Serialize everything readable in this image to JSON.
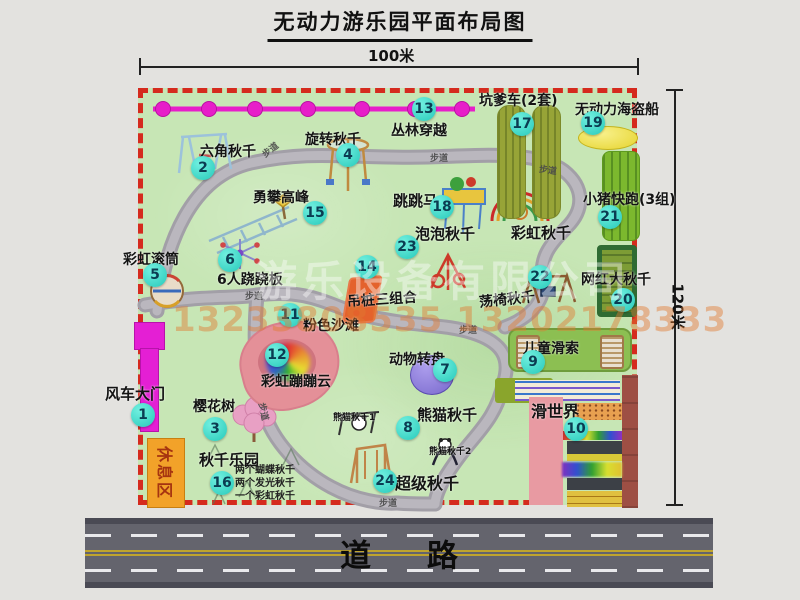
{
  "title": "无动力游乐园平面布局图",
  "dimensions": {
    "top": "100米",
    "right": "120米"
  },
  "road_label": "道路",
  "watermark": {
    "company": "游乐设备有限公司",
    "phone": "13233808535 13202178333"
  },
  "labels": {
    "walkway": "步道",
    "rainbow_swing": "彩虹秋千",
    "rest_area": "休息区"
  },
  "colors": {
    "map_green": "#c7e6b5",
    "border_red": "#d52a1e",
    "zipline_pink": "#e71ec9",
    "marker_cyan": "#27c9ba",
    "rest_orange": "#f2a229",
    "road_gray": "#64646d",
    "gate_magenta": "#e41fd4"
  },
  "attractions": [
    {
      "num": "1",
      "label": "风车大门"
    },
    {
      "num": "2",
      "label": "六角秋千"
    },
    {
      "num": "3",
      "label": "樱花树"
    },
    {
      "num": "4",
      "label": "旋转秋千"
    },
    {
      "num": "5",
      "label": "彩虹滚筒"
    },
    {
      "num": "6",
      "label": "6人跷跷板"
    },
    {
      "num": "7",
      "label": "动物转盘"
    },
    {
      "num": "8",
      "label": "熊猫秋千",
      "sub1": "熊猫秋千1",
      "sub2": "熊猫秋千2"
    },
    {
      "num": "9",
      "label": "儿童滑索"
    },
    {
      "num": "10",
      "label": "滑世界"
    },
    {
      "num": "11",
      "label": "粉色沙滩"
    },
    {
      "num": "12",
      "label": "彩虹蹦蹦云"
    },
    {
      "num": "13",
      "label": "丛林穿越"
    },
    {
      "num": "14",
      "label": "吊桩三组合"
    },
    {
      "num": "15",
      "label": "勇攀高峰"
    },
    {
      "num": "16",
      "label": "秋千乐园",
      "notes": [
        "两个蝴蝶秋千",
        "两个发光秋千",
        "一个彩虹秋千"
      ]
    },
    {
      "num": "17",
      "label": "坑爹车(2套)"
    },
    {
      "num": "18",
      "label": "跳跳马"
    },
    {
      "num": "19",
      "label": "无动力海盗船"
    },
    {
      "num": "20",
      "label": "网红大秋千"
    },
    {
      "num": "21",
      "label": "小猪快跑(3组)"
    },
    {
      "num": "22",
      "label": "荡椅秋千"
    },
    {
      "num": "23",
      "label": "泡泡秋千"
    },
    {
      "num": "24",
      "label": "超级秋千"
    }
  ]
}
